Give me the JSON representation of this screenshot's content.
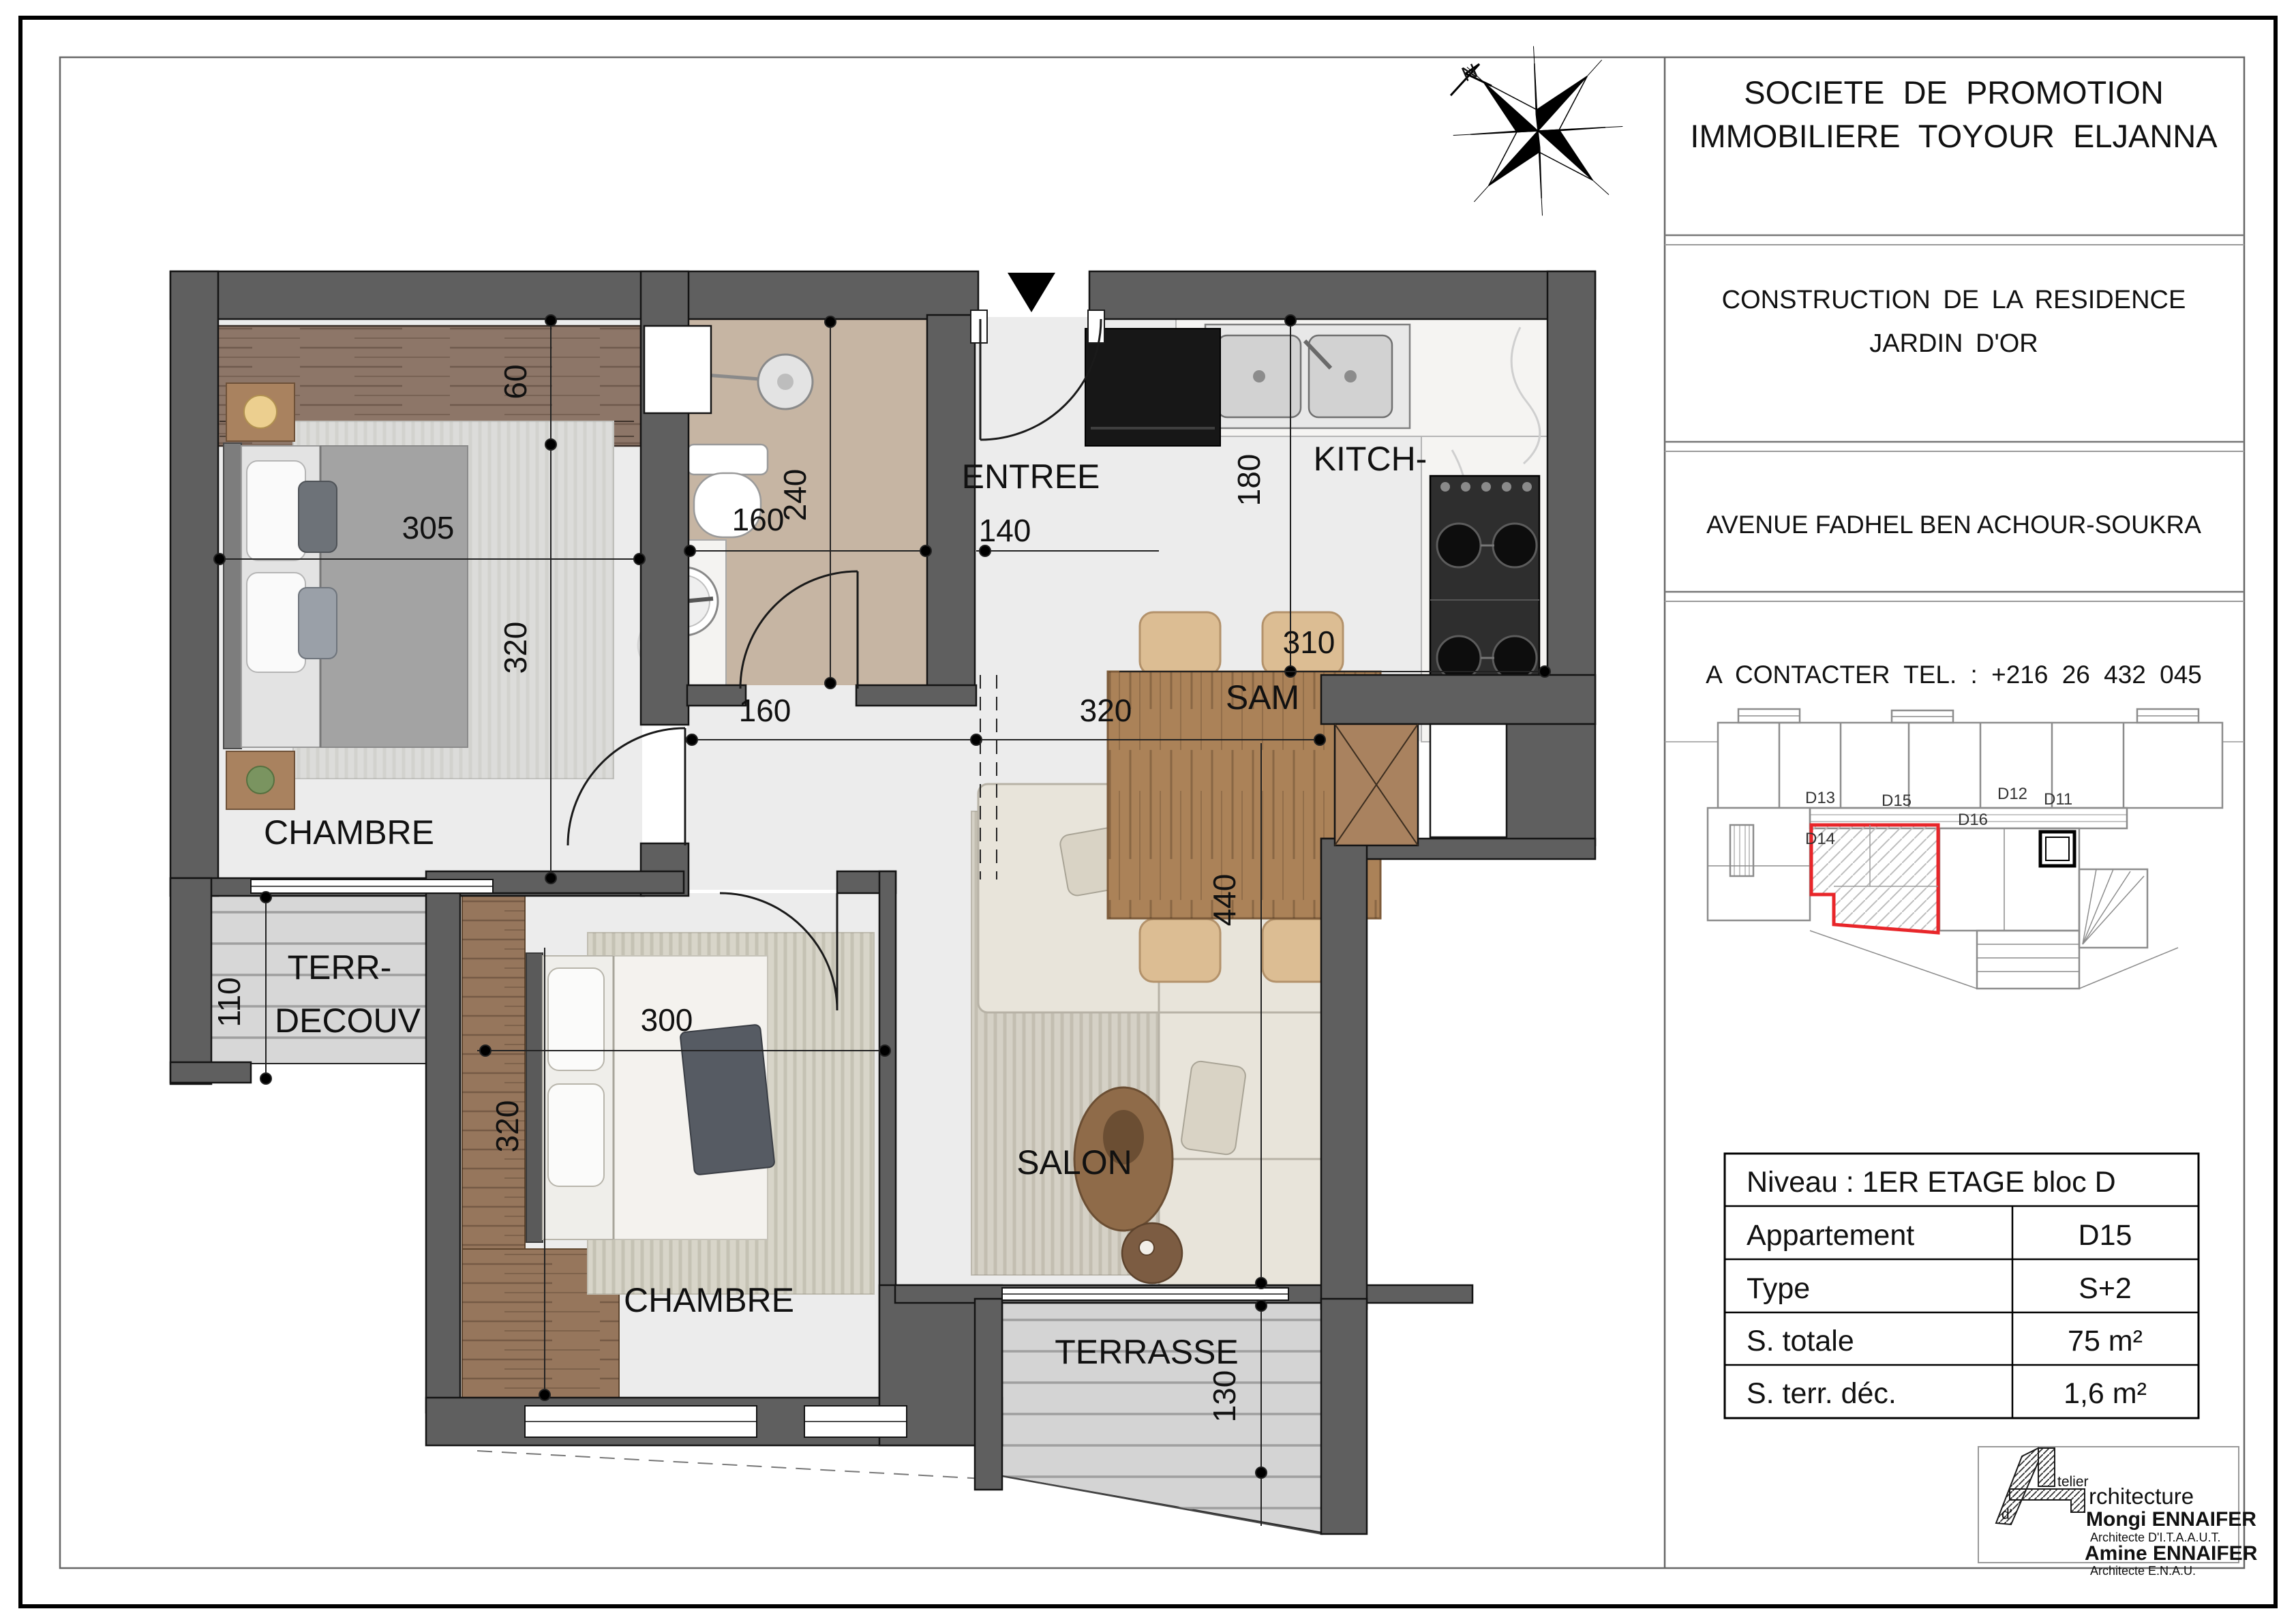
{
  "company": {
    "line1": "SOCIETE DE PROMOTION",
    "line2": "IMMOBILIERE TOYOUR ELJANNA"
  },
  "project": {
    "line1": "CONSTRUCTION DE LA RESIDENCE",
    "line2": "JARDIN D'OR"
  },
  "address": "AVENUE FADHEL BEN ACHOUR-SOUKRA",
  "contact": "A CONTACTER TEL. : +216 26 432 045",
  "compass": {
    "north": "N"
  },
  "plan": {
    "rooms": {
      "chambre1": "CHAMBRE",
      "chambre2": "CHAMBRE",
      "entree": "ENTREE",
      "kitchen": "KITCH-",
      "sam": "SAM",
      "salon": "SALON",
      "terrasse": "TERRASSE",
      "terr_decouv_line1": "TERR-",
      "terr_decouv_line2": "DECOUV"
    },
    "dims": {
      "chambre1_width": "305",
      "chambre1_height": "320",
      "dressing_depth": "60",
      "bath_width": "160",
      "bath_height": "240",
      "entree_width": "140",
      "kitchen_height": "180",
      "kitchen_width": "310",
      "hall_width": "160",
      "sam_width": "320",
      "salon_height": "440",
      "terrasse_height": "130",
      "terr_decouv_height": "110",
      "chambre2_width": "300",
      "chambre2_height": "320"
    }
  },
  "key_plan": {
    "units": {
      "d13": "D13",
      "d14": "D14",
      "d15": "D15",
      "d16": "D16",
      "d12": "D12",
      "d11": "D11"
    }
  },
  "info_table": {
    "header": "Niveau : 1ER ETAGE bloc D",
    "rows": [
      {
        "label": "Appartement",
        "value": "D15"
      },
      {
        "label": "Type",
        "value": "S+2"
      },
      {
        "label": "S. totale",
        "value": "75 m²"
      },
      {
        "label": "S. terr. déc.",
        "value": "1,6 m²"
      }
    ]
  },
  "architects": {
    "atelier_suffix": "telier",
    "architecture_suffix": "rchitecture",
    "d_apostrophe": "d'",
    "name1": "Mongi ENNAIFER",
    "title1": "Architecte D'I.T.A.A.U.T.",
    "name2": "Amine ENNAIFER",
    "title2": "Architecte  E.N.A.U."
  }
}
